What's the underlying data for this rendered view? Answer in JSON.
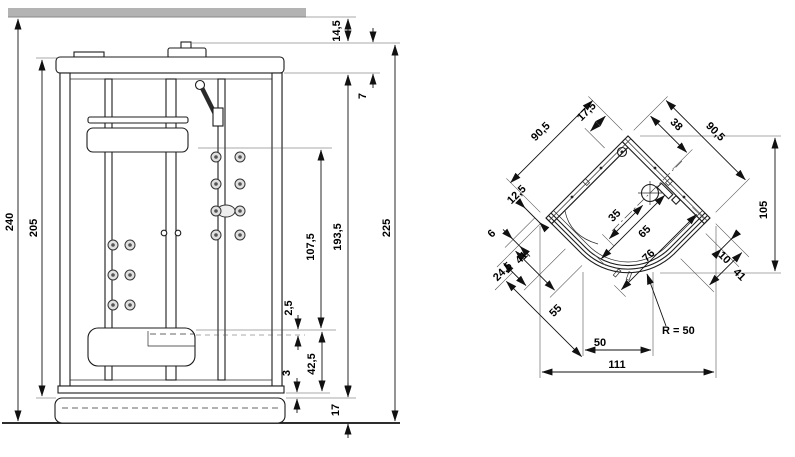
{
  "front_view": {
    "floor_to_ceiling": "240",
    "body_height": "205",
    "ceiling_clearance": "14,5",
    "roof_cap_height": "7",
    "jet_panel_height": "107,5",
    "seat_gap": "2,5",
    "seat_height": "42,5",
    "base_lip": "3",
    "tray_height": "17",
    "glass_height": "193,5",
    "cabin_height": "225"
  },
  "plan_view": {
    "left_wall_length": "90,5",
    "corner_offset_left": "17,5",
    "corner_offset_right": "38",
    "right_wall_length": "90,5",
    "wall_glass_inset": "12,5",
    "drain_offset": "35",
    "mixer_offset": "65",
    "door_opening": "76",
    "profile_width": "6",
    "left_panel_width": "41",
    "left_inner_width": "24,5",
    "door_diagonal": "55",
    "right_inner_width": "10",
    "right_panel_width": "41",
    "depth": "105",
    "front_chord_width": "50",
    "overall_width": "111",
    "front_radius": "R = 50"
  },
  "colors": {
    "ceiling_bar": "#b3b3b3"
  }
}
